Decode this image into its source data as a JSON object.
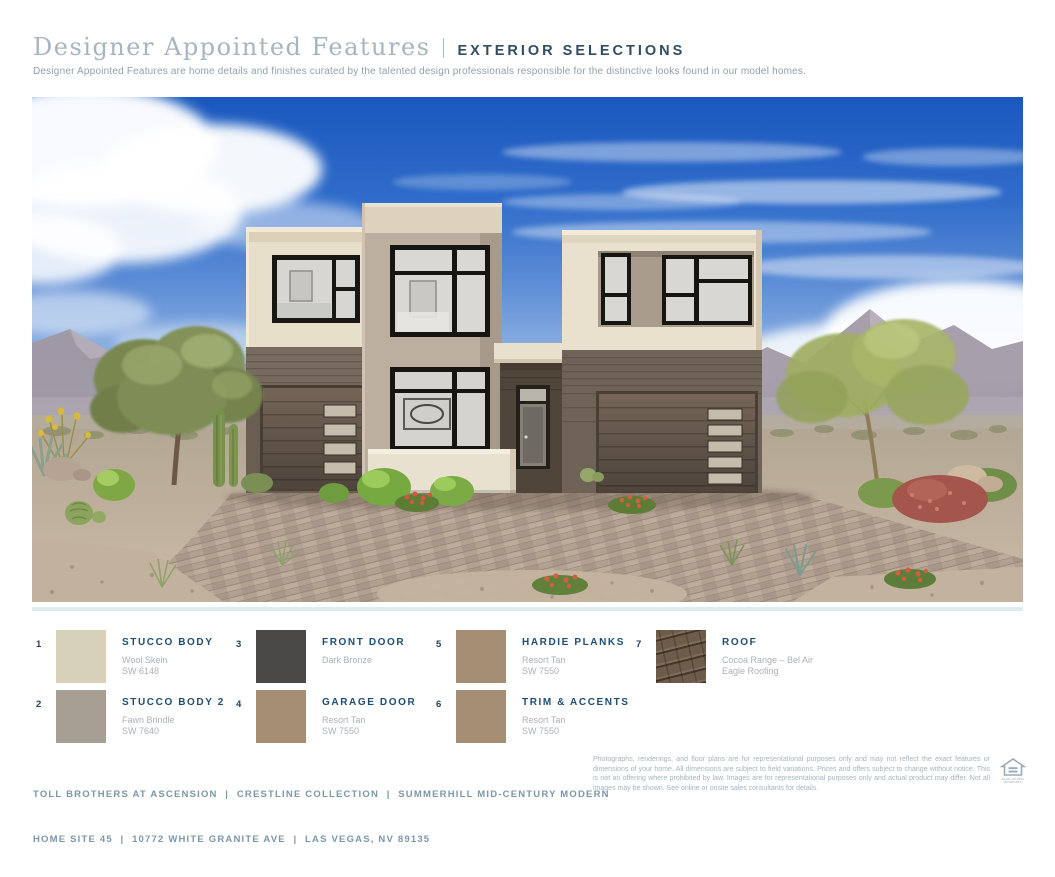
{
  "header": {
    "title": "Designer Appointed Features",
    "tag": "EXTERIOR SELECTIONS",
    "subtitle": "Designer Appointed Features are home details and finishes curated by the talented design professionals responsible for the distinctive looks found in our model homes."
  },
  "selections": [
    {
      "num": "1",
      "label": "STUCCO BODY",
      "line1": "Wool Skein",
      "line2": "SW 6148",
      "color": "#d8d1b9"
    },
    {
      "num": "2",
      "label": "STUCCO BODY 2",
      "line1": "Fawn Brindle",
      "line2": "SW 7640",
      "color": "#a79e94"
    },
    {
      "num": "3",
      "label": "FRONT DOOR",
      "line1": "Dark Bronze",
      "line2": "",
      "color": "#4a4948"
    },
    {
      "num": "4",
      "label": "GARAGE DOOR",
      "line1": "Resort Tan",
      "line2": "SW 7550",
      "color": "#a68e74"
    },
    {
      "num": "5",
      "label": "HARDIE PLANKS",
      "line1": "Resort Tan",
      "line2": "SW 7550",
      "color": "#a68e74"
    },
    {
      "num": "6",
      "label": "TRIM & ACCENTS",
      "line1": "Resort Tan",
      "line2": "SW 7550",
      "color": "#a68e74"
    },
    {
      "num": "7",
      "label": "ROOF",
      "line1": "Cocoa Range – Bel Air",
      "line2": "Eagle Roofing",
      "color": "#6e5c4b"
    }
  ],
  "footer": {
    "line1": "TOLL BROTHERS AT ASCENSION  |  CRESTLINE COLLECTION  |  SUMMERHILL MID-CENTURY MODERN",
    "line2": "HOME SITE 45  |  10772 WHITE GRANITE AVE  |  LAS VEGAS, NV 89135",
    "disclaimer": "Photographs, renderings, and floor plans are for representational purposes only and may not reflect the exact features or dimensions of your home. All dimensions are subject to field variations. Prices and offers subject to change without notice. This is not an offering where prohibited by law. Images are for representational purposes only and actual product may differ. Not all images may be shown. See online or onsite sales consultants for details.",
    "equal_housing": "EQUAL HOUSING OPPORTUNITY"
  }
}
